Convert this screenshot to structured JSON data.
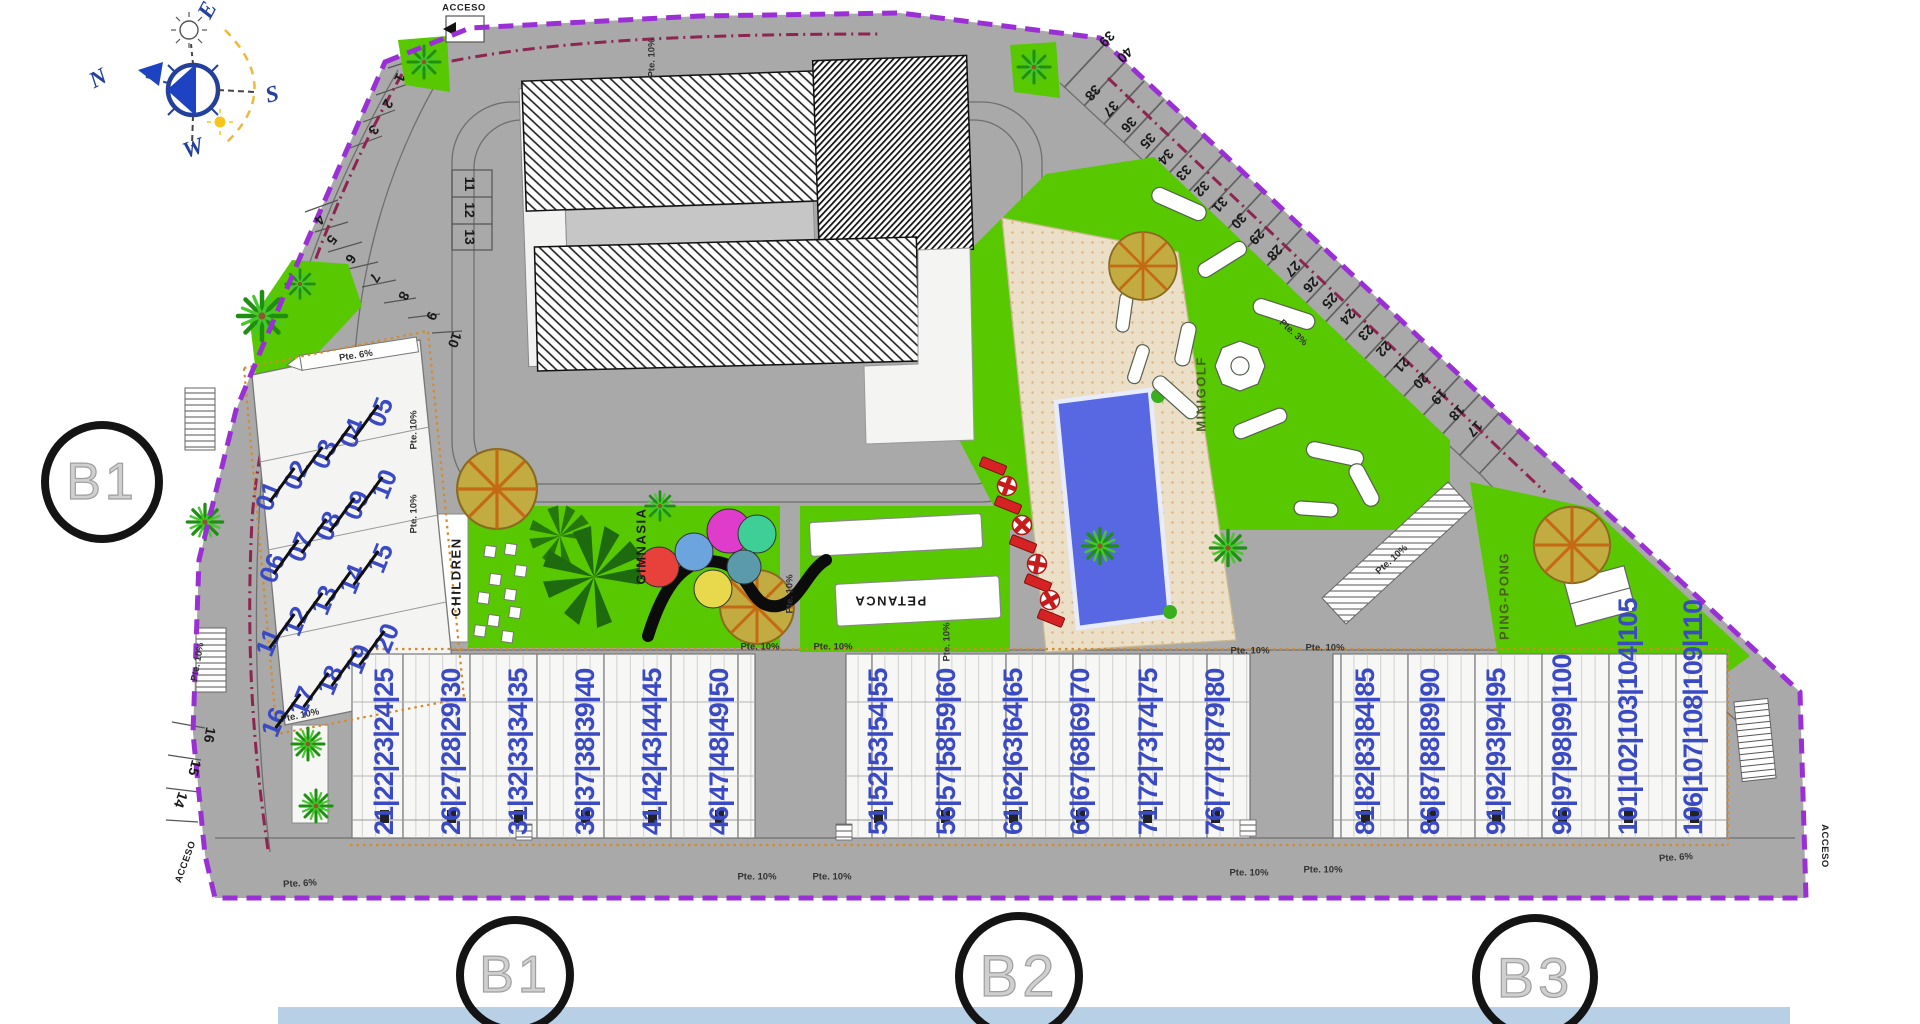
{
  "site": {
    "boundary_color": "#9b2fd6",
    "green": "#58c801",
    "road_gray": "#a9a9a9",
    "unit_number_blue": "#3a49c4",
    "pool_blue": "#5868e2",
    "deck_beige": "#ecdfc8",
    "accent_orange": "#d6892b"
  },
  "compass": {
    "north": "N",
    "east": "E",
    "south": "S",
    "west": "W"
  },
  "access": {
    "top": "ACCESO",
    "bottom_left": "ACCESO",
    "bottom_right": "ACCESO"
  },
  "markers": {
    "left": "B1",
    "bottom_1": "B1",
    "bottom_2": "B2",
    "bottom_3": "B3"
  },
  "amenities": {
    "children": "CHILDREN",
    "gym": "GIMNASIA",
    "petanque": "PETANCA",
    "minigolf": "MINIGOLF",
    "pingpong": "PING-PONG"
  },
  "slopes": {
    "p3": "Pte. 3%",
    "p6": "Pte. 6%",
    "p10": "Pte. 10%"
  },
  "parking": {
    "left_upper": [
      "1",
      "2",
      "3"
    ],
    "left_mid": [
      "4",
      "5",
      "6",
      "7",
      "8",
      "9",
      "10"
    ],
    "left_box": [
      "11",
      "12",
      "13"
    ],
    "left_lower": [
      "14",
      "15",
      "16"
    ],
    "diag_top": [
      "39",
      "40"
    ],
    "diagonal": [
      "38",
      "37",
      "36",
      "35",
      "34",
      "33",
      "32",
      "31",
      "30",
      "29",
      "28",
      "27",
      "26",
      "25",
      "24",
      "23",
      "22",
      "21",
      "20",
      "19",
      "18",
      "17"
    ]
  },
  "units": {
    "b1_left": [
      [
        "01",
        "02",
        "03",
        "04",
        "05"
      ],
      [
        "06",
        "07",
        "08",
        "09",
        "10"
      ],
      [
        "11",
        "12",
        "13",
        "14",
        "15"
      ],
      [
        "16",
        "17",
        "18",
        "19",
        "20"
      ]
    ],
    "b1_bottom": [
      "21|22|23|24|25",
      "26|27|28|29|30",
      "31|32|33|34|35",
      "36|37|38|39|40",
      "41|42|43|44|45",
      "46|47|48|49|50"
    ],
    "b2_bottom": [
      "51|52|53|54|55",
      "56|57|58|59|60",
      "61|62|63|64|65",
      "66|67|68|69|70",
      "71|72|73|74|75",
      "76|77|78|79|80"
    ],
    "b3_bottom": [
      "81|82|83|84|85",
      "86|87|88|89|90",
      "91|92|93|94|95",
      "96|97|98|99|100",
      "101|102|103|104|105",
      "106|107|108|109|110"
    ]
  }
}
